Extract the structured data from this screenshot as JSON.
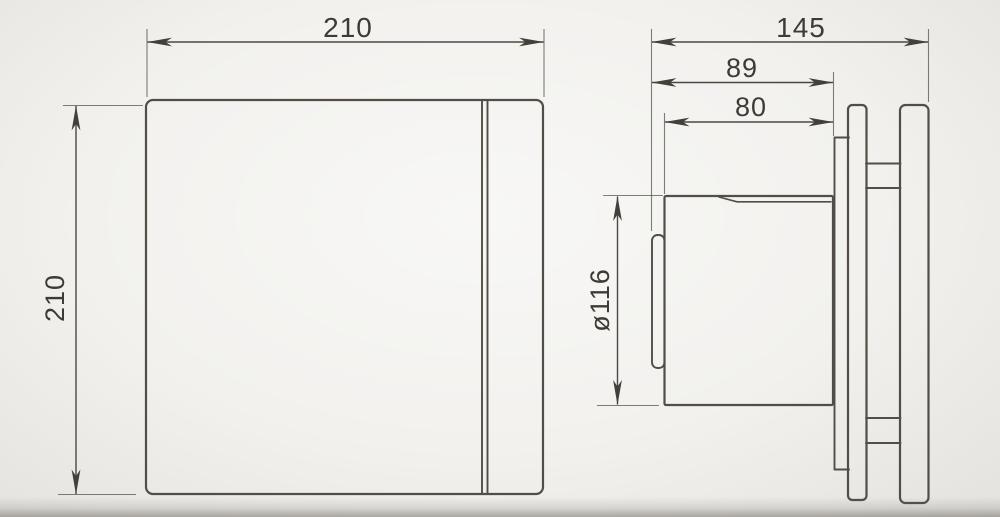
{
  "drawing": {
    "front_view": {
      "width_label": "210",
      "height_label": "210"
    },
    "side_view": {
      "overall_depth_label": "145",
      "mounting_depth_label": "89",
      "duct_length_label": "80",
      "duct_diameter_label": "ø116"
    }
  },
  "colors": {
    "line": "#524d46",
    "dim_line": "#4c4841",
    "text": "#3e3b36",
    "background": "#f2f1ee"
  }
}
